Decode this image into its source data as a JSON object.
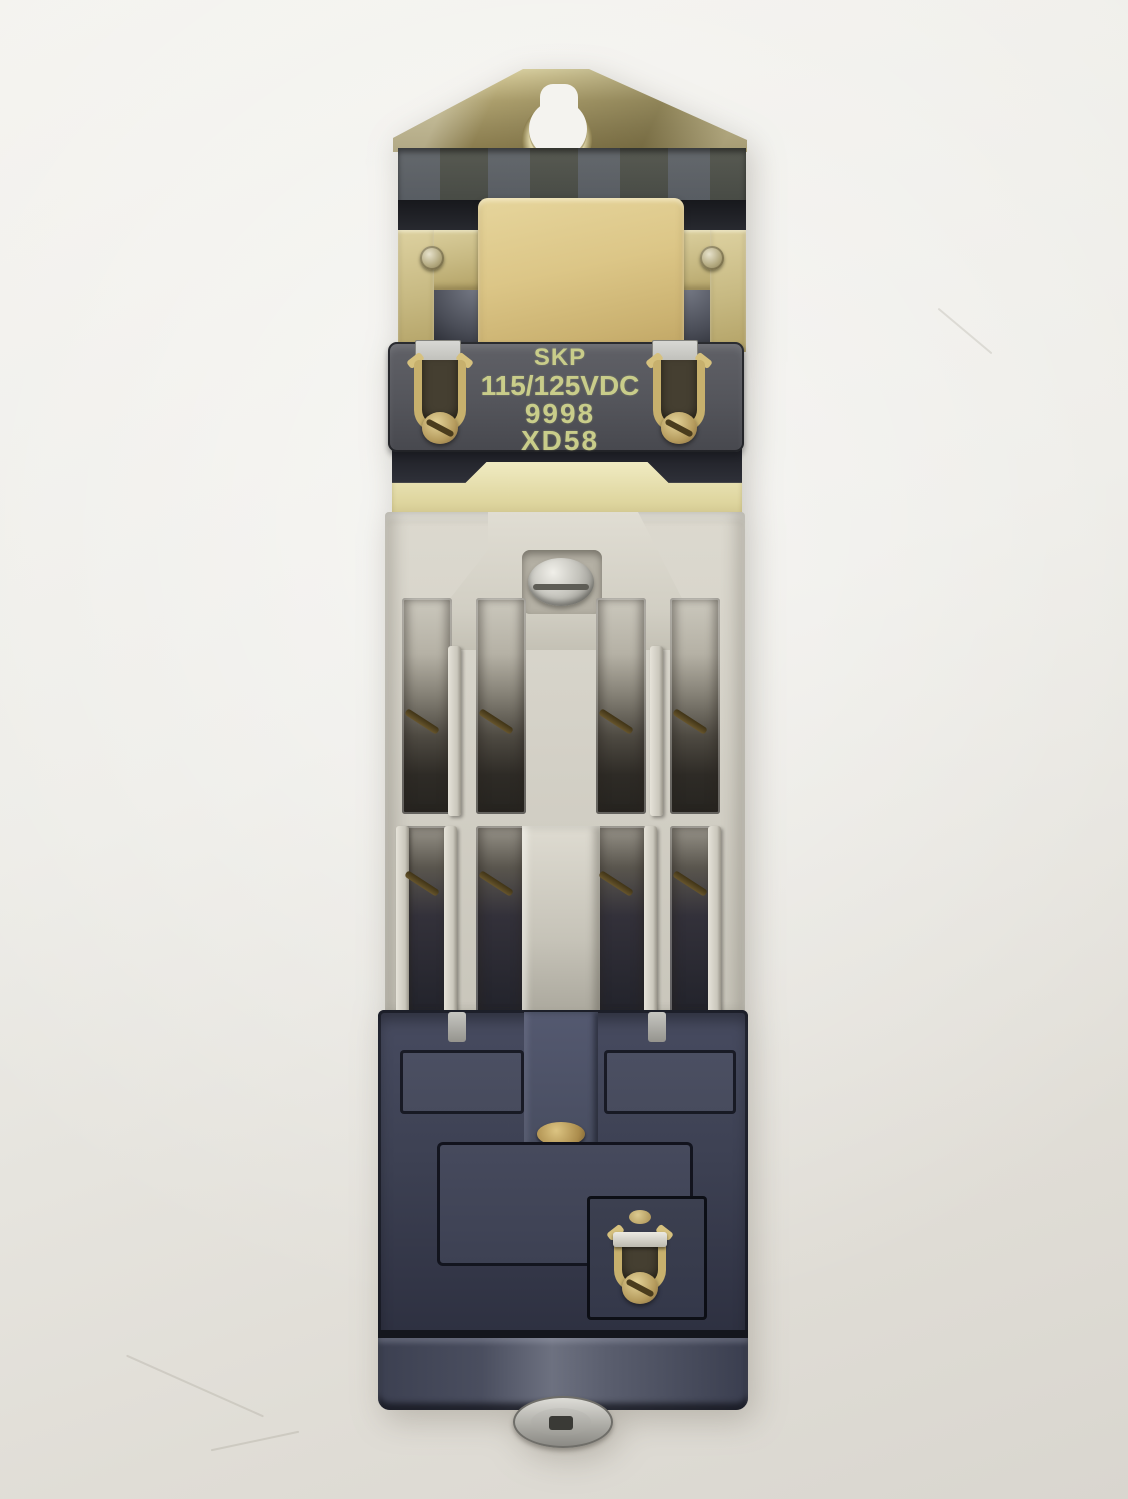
{
  "scene": {
    "type": "product-photo",
    "subject": "industrial DC relay contactor, front view, on light background",
    "background_color": "#efeeea"
  },
  "label": {
    "brand": "SKP",
    "voltage": "115/125VDC",
    "number": "9998",
    "code": "XD58",
    "text_color": "#c9cd8a",
    "plate_color": "#54555b"
  },
  "colors": {
    "bracket_brass": "#b0a26e",
    "coil_core_tan": "#d5bf82",
    "contact_body_gray": "#d6d3c9",
    "terminal_brass": "#c0a96a",
    "lower_housing_navy": "#3e4254",
    "gasket_cream": "#e9e4b8",
    "hardware_silver": "#c2c1bc"
  },
  "parts": {
    "mounting_bracket": "brass keyhole mounting bracket",
    "coil": "coil with laminated tan core",
    "terminal_screws": "8 slotted brass terminal screws in two rows",
    "clamp_terminals": "brass wire clamp terminals",
    "base_nut": "steel hex nut on base"
  }
}
